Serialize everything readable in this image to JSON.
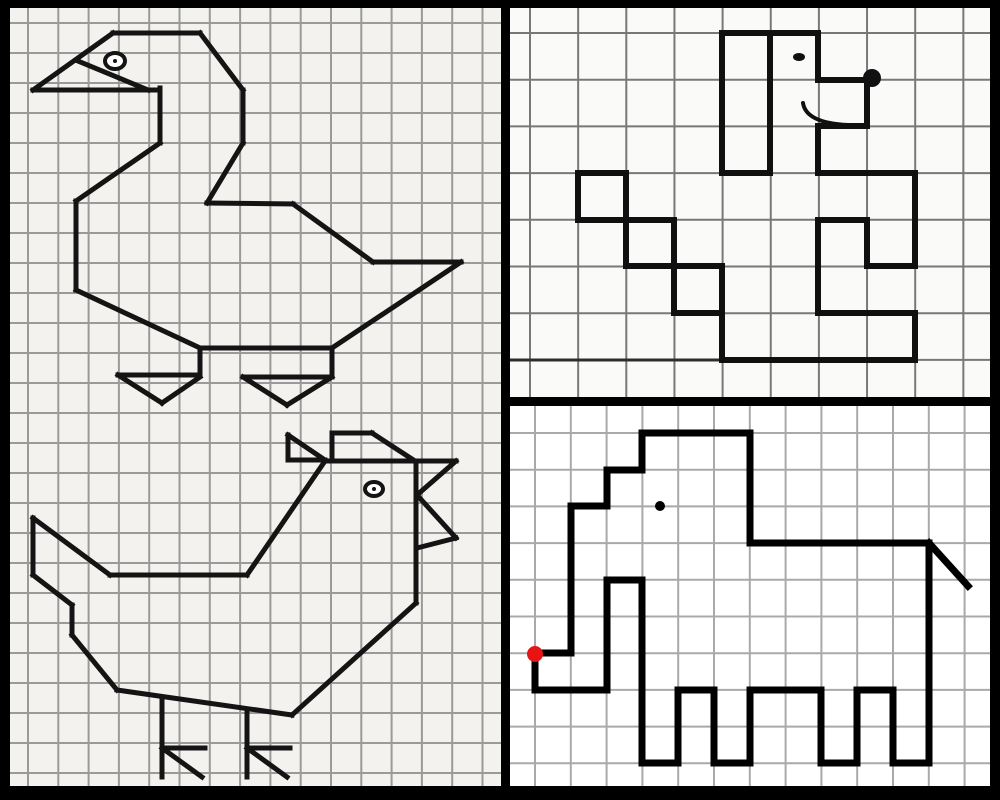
{
  "canvas": {
    "width": 1000,
    "height": 800,
    "frame_color": "#000000"
  },
  "panels": [
    {
      "name": "goose-and-chicken-panel",
      "rect": [
        10,
        8,
        491,
        778
      ],
      "bg": "#f3f2ee",
      "grid": {
        "color": "#9a9a9a",
        "line_width": 2,
        "x_start": 28,
        "x_step": 30.3,
        "x_count": 16,
        "y_start": 23,
        "y_step": 30,
        "y_count": 26
      },
      "figures": [
        {
          "name": "goose",
          "stroke": "#141414",
          "line_width": 5,
          "segments": [
            [
              33,
              90,
              113,
              33
            ],
            [
              113,
              33,
              200,
              33
            ],
            [
              200,
              33,
              243,
              90
            ],
            [
              243,
              90,
              243,
              143
            ],
            [
              243,
              143,
              207,
              203
            ],
            [
              207,
              203,
              293,
              204
            ],
            [
              293,
              204,
              373,
              262
            ],
            [
              373,
              262,
              461,
              262
            ],
            [
              461,
              262,
              332,
              348
            ],
            [
              332,
              348,
              200,
              348
            ],
            [
              200,
              348,
              76,
              290
            ],
            [
              76,
              290,
              76,
              201
            ],
            [
              76,
              201,
              160,
              143
            ],
            [
              160,
              143,
              160,
              88
            ],
            [
              160,
              90,
              33,
              90
            ],
            [
              78,
              61,
              148,
              90
            ],
            [
              200,
              348,
              200,
              375
            ],
            [
              118,
              375,
              200,
              375
            ],
            [
              118,
              375,
              162,
              403
            ],
            [
              162,
              403,
              200,
              377
            ],
            [
              332,
              348,
              332,
              377
            ],
            [
              243,
              377,
              332,
              377
            ],
            [
              243,
              377,
              287,
              405
            ],
            [
              287,
              405,
              332,
              377
            ]
          ],
          "rings": [
            {
              "name": "goose-eye",
              "cx": 115,
              "cy": 61,
              "rx": 10,
              "ry": 8,
              "line_width": 4,
              "dot_r": 2
            }
          ]
        },
        {
          "name": "chicken",
          "stroke": "#141414",
          "line_width": 5,
          "segments": [
            [
              288,
              435,
              288,
              460
            ],
            [
              288,
              435,
              325,
              460
            ],
            [
              288,
              460,
              325,
              460
            ],
            [
              332,
              433,
              332,
              461
            ],
            [
              332,
              433,
              372,
              433
            ],
            [
              372,
              433,
              415,
              461
            ],
            [
              325,
              461,
              456,
              461
            ],
            [
              456,
              461,
              417,
              495
            ],
            [
              417,
              495,
              456,
              538
            ],
            [
              456,
              538,
              417,
              548
            ],
            [
              416,
              461,
              416,
              603
            ],
            [
              325,
              461,
              247,
              575
            ],
            [
              247,
              575,
              110,
              575
            ],
            [
              110,
              575,
              33,
              518
            ],
            [
              33,
              518,
              33,
              575
            ],
            [
              33,
              575,
              72,
              605
            ],
            [
              72,
              605,
              72,
              635
            ],
            [
              72,
              635,
              117,
              690
            ],
            [
              117,
              690,
              292,
              715
            ],
            [
              416,
              603,
              292,
              715
            ],
            [
              162,
              697,
              162,
              777
            ],
            [
              162,
              748,
              205,
              748
            ],
            [
              162,
              748,
              202,
              777
            ],
            [
              247,
              709,
              247,
              777
            ],
            [
              247,
              748,
              290,
              748
            ],
            [
              247,
              748,
              287,
              777
            ]
          ],
          "rings": [
            {
              "name": "chicken-eye",
              "cx": 374,
              "cy": 489,
              "rx": 9,
              "ry": 7,
              "line_width": 4,
              "dot_r": 2
            }
          ]
        }
      ]
    },
    {
      "name": "dog-panel",
      "rect": [
        510,
        8,
        480,
        389
      ],
      "bg": "#fafaf8",
      "grid": {
        "color": "#787878",
        "line_width": 2,
        "x_start": 530,
        "x_step": 48.15,
        "x_count": 10,
        "y_start": 33,
        "y_step": 46.7,
        "y_count": 8
      },
      "figures": [
        {
          "name": "ground-line",
          "stroke": "#2e2e2e",
          "line_width": 3,
          "segments": [
            [
              510,
              360,
              724,
              360
            ]
          ]
        },
        {
          "name": "dog",
          "stroke": "#101010",
          "line_width": 6,
          "segments": [
            [
              722,
              33,
              818,
              33
            ],
            [
              722,
              33,
              722,
              173
            ],
            [
              770,
              33,
              770,
              173
            ],
            [
              722,
              173,
              770,
              173
            ],
            [
              818,
              33,
              818,
              80
            ],
            [
              818,
              80,
              867,
              80
            ],
            [
              867,
              80,
              867,
              126
            ],
            [
              818,
              126,
              867,
              126
            ],
            [
              818,
              126,
              818,
              173
            ],
            [
              818,
              173,
              915,
              173
            ],
            [
              915,
              173,
              915,
              266
            ],
            [
              867,
              266,
              915,
              266
            ],
            [
              867,
              220,
              867,
              266
            ],
            [
              818,
              220,
              867,
              220
            ],
            [
              818,
              220,
              818,
              313
            ],
            [
              818,
              313,
              915,
              313
            ],
            [
              915,
              313,
              915,
              360
            ],
            [
              722,
              360,
              915,
              360
            ],
            [
              722,
              313,
              722,
              360
            ],
            [
              578,
              173,
              626,
              173
            ],
            [
              626,
              173,
              626,
              220
            ],
            [
              578,
              220,
              626,
              220
            ],
            [
              578,
              173,
              578,
              220
            ],
            [
              626,
              220,
              674,
              220
            ],
            [
              674,
              220,
              674,
              266
            ],
            [
              626,
              266,
              674,
              266
            ],
            [
              626,
              220,
              626,
              266
            ],
            [
              674,
              266,
              722,
              266
            ],
            [
              722,
              266,
              722,
              313
            ],
            [
              674,
              313,
              722,
              313
            ],
            [
              674,
              266,
              674,
              313
            ]
          ],
          "curves": [
            {
              "name": "dog-smile",
              "p0": [
                803,
                103
              ],
              "p1": [
                806,
                123
              ],
              "p2": [
                848,
                125
              ],
              "line_width": 4
            }
          ],
          "dots": [
            {
              "name": "dog-eye",
              "cx": 799,
              "cy": 57,
              "rx": 6,
              "ry": 4
            },
            {
              "name": "dog-nose",
              "cx": 872,
              "cy": 78,
              "r": 9
            }
          ]
        }
      ]
    },
    {
      "name": "elephant-panel",
      "rect": [
        510,
        406,
        480,
        380
      ],
      "bg": "#ffffff",
      "grid": {
        "color": "#a9a9a9",
        "line_width": 2,
        "x_start": 535,
        "x_step": 35.8,
        "x_count": 13,
        "y_start": 433,
        "y_step": 36.7,
        "y_count": 10
      },
      "figures": [
        {
          "name": "elephant",
          "stroke": "#000000",
          "line_width": 7,
          "segments": [
            [
              642,
              433,
              750,
              433
            ],
            [
              750,
              433,
              750,
              543
            ],
            [
              750,
              543,
              929,
              543
            ],
            [
              929,
              543,
              968,
              586
            ],
            [
              929,
              543,
              929,
              763
            ],
            [
              893,
              763,
              929,
              763
            ],
            [
              893,
              690,
              893,
              763
            ],
            [
              857,
              690,
              893,
              690
            ],
            [
              857,
              690,
              857,
              763
            ],
            [
              821,
              763,
              857,
              763
            ],
            [
              821,
              690,
              821,
              763
            ],
            [
              750,
              690,
              821,
              690
            ],
            [
              750,
              690,
              750,
              763
            ],
            [
              714,
              763,
              750,
              763
            ],
            [
              714,
              690,
              714,
              763
            ],
            [
              678,
              690,
              714,
              690
            ],
            [
              678,
              690,
              678,
              763
            ],
            [
              642,
              763,
              678,
              763
            ],
            [
              642,
              580,
              642,
              763
            ],
            [
              607,
              580,
              642,
              580
            ],
            [
              607,
              580,
              607,
              690
            ],
            [
              535,
              690,
              607,
              690
            ],
            [
              535,
              653,
              535,
              690
            ],
            [
              535,
              653,
              571,
              653
            ],
            [
              571,
              506,
              571,
              653
            ],
            [
              571,
              506,
              607,
              506
            ],
            [
              607,
              470,
              607,
              506
            ],
            [
              607,
              470,
              642,
              470
            ],
            [
              642,
              433,
              642,
              470
            ]
          ],
          "dots": [
            {
              "name": "elephant-eye",
              "cx": 660,
              "cy": 506,
              "r": 5
            },
            {
              "name": "start-dot",
              "cx": 535,
              "cy": 654,
              "r": 8,
              "fill": "#e81414"
            }
          ]
        }
      ]
    }
  ],
  "borders": [
    {
      "name": "border-top",
      "rect": [
        0,
        0,
        1000,
        8
      ]
    },
    {
      "name": "border-left",
      "rect": [
        0,
        0,
        10,
        800
      ]
    },
    {
      "name": "border-bottom",
      "rect": [
        0,
        786,
        1000,
        14
      ]
    },
    {
      "name": "border-right",
      "rect": [
        990,
        0,
        10,
        800
      ]
    },
    {
      "name": "divider-vertical",
      "rect": [
        501,
        0,
        9,
        800
      ]
    },
    {
      "name": "divider-horizontal",
      "rect": [
        501,
        397,
        499,
        9
      ]
    }
  ]
}
